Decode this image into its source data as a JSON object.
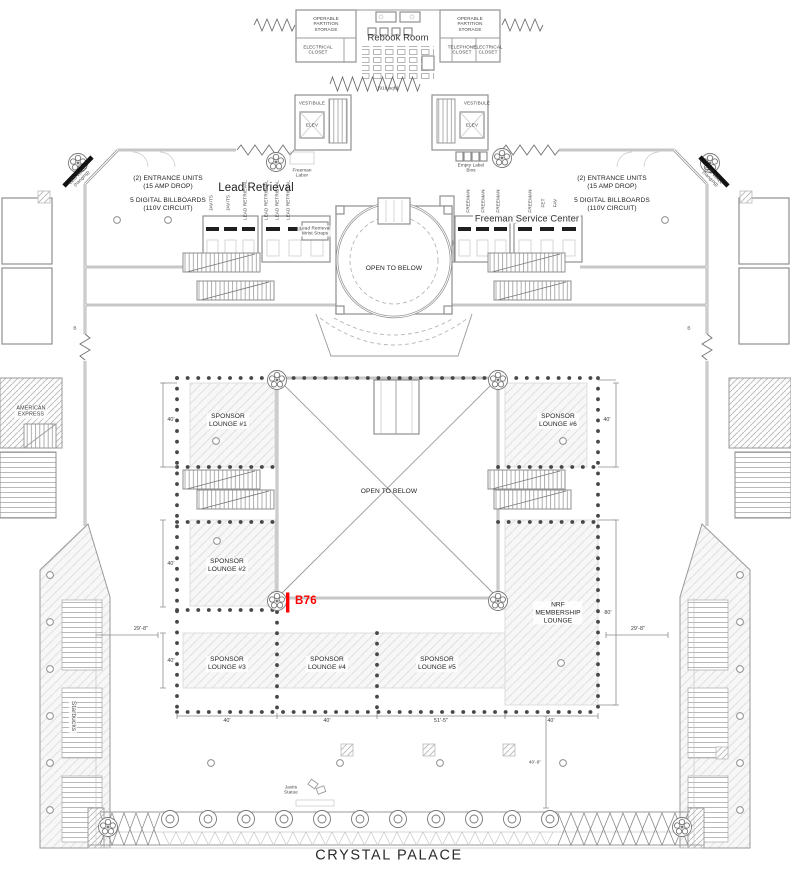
{
  "plan": {
    "venue_name": "CRYSTAL PALACE",
    "selected_booth": {
      "id": "B76",
      "color": "#FF0000"
    }
  },
  "rebook": {
    "title": "Rebook Room",
    "area": "(916 sqft)",
    "storage_left": "OPERABLE\nPARTITION\nSTORAGE",
    "storage_right": "OPERABLE\nPARTITION\nSTORAGE",
    "electrical_left": "ELECTRICAL\nCLOSET",
    "electrical_right": "ELECTRICAL\nCLOSET",
    "telephone_right": "TELEPHONE\nCLOSET",
    "vestibule_left": "VESTIBULE",
    "vestibule_right": "VESTIBULE",
    "elevator_left": "ELEV",
    "elevator_right": "ELEV"
  },
  "services": {
    "lead_retrieval_heading": "Lead Retrieval",
    "freeman_heading": "Freeman Service Center",
    "freeman_labor": "Freeman\nLabor",
    "empty_label_bins": "Empty Label\nBins",
    "wrist_straps": "Lead Retrieval\nWrist Straps",
    "left_counter_labels": [
      "JAVITS",
      "JAVITS",
      "LEAD RETRIEVAL",
      "LEAD RETRIEVAL",
      "LEAD RETRIEVAL",
      "LEAD RETRIEVAL"
    ],
    "right_counter_labels": [
      "FREEMAN",
      "FREEMAN",
      "FREEMAN",
      "FREEMAN",
      "FET",
      "FAV"
    ]
  },
  "annotations": {
    "entrance_units": "(2) ENTRANCE UNITS\n(15 AMP DROP)",
    "digital_billboards": "5 DIGITAL BILLBOARDS\n(110V CIRCUIT)",
    "led_wall": "LED WALL\n(hanging)",
    "open_to_below": "OPEN TO BELOW",
    "american_express": "AMERICAN\nEXPRESS",
    "starbucks": "Starbucks",
    "javits_statue": "Javits\nStatue",
    "b_marker": "B"
  },
  "lounges": [
    {
      "label": "SPONSOR\nLOUNGE #1"
    },
    {
      "label": "SPONSOR\nLOUNGE #2"
    },
    {
      "label": "SPONSOR\nLOUNGE #3"
    },
    {
      "label": "SPONSOR\nLOUNGE #4"
    },
    {
      "label": "SPONSOR\nLOUNGE #5"
    },
    {
      "label": "SPONSOR\nLOUNGE #6"
    },
    {
      "label": "NRF\nMEMBERSHIP\nLOUNGE"
    }
  ],
  "dimensions": {
    "w40": "40'",
    "w51_5": "51'-5\"",
    "w29_8": "29'-8\"",
    "w80": "80'",
    "w40_8": "40'-8\""
  }
}
